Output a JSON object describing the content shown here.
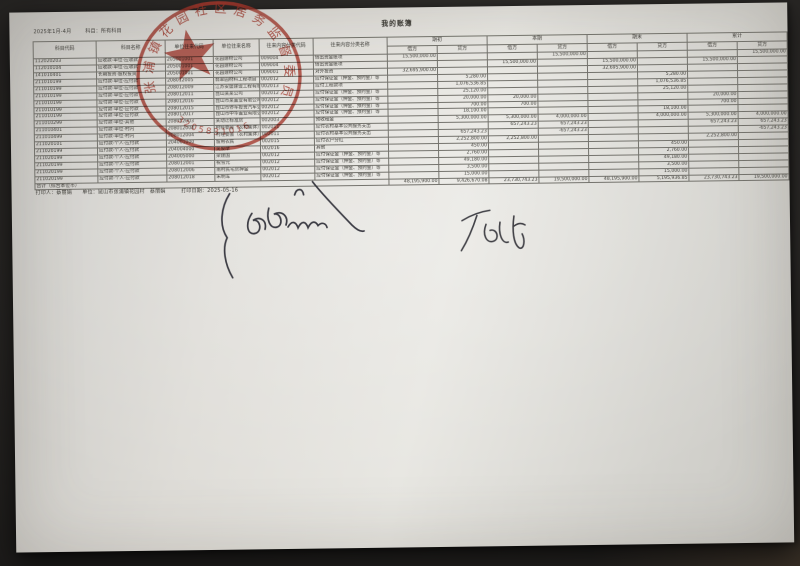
{
  "meta": {
    "period": "2025年1月-4月",
    "subject_filter": "科目：所有科目",
    "title": "我的账簿"
  },
  "table": {
    "headers": {
      "cols": [
        "科目代码",
        "科目名称",
        "单位往来代码",
        "单位往来名称",
        "往来内容分类代码",
        "往来内容分类名称"
      ],
      "groups": [
        "期初",
        "本期",
        "期末",
        "累计"
      ],
      "sub": [
        "借方",
        "贷方"
      ]
    },
    "rows": [
      [
        "112020203",
        "应收款-单位-应收款",
        "205001001",
        "花园建材公司",
        "009004",
        "借出资金账项",
        "15,500,000.00",
        "",
        "",
        "15,500,000.00",
        "",
        "",
        "",
        "15,500,000.00"
      ],
      [
        "112010104",
        "应收款-单位-应收款",
        "205001001",
        "花园建材公司",
        "009004",
        "借出资金账项",
        "",
        "",
        "15,500,000.00",
        "",
        "15,500,000.00",
        "",
        "15,500,000.00",
        ""
      ],
      [
        "141010401",
        "长期投资-股权投资",
        "205001001",
        "花园建材公司",
        "009001",
        "对外投资",
        "32,695,900.00",
        "",
        "",
        "",
        "32,695,900.00",
        "",
        "",
        ""
      ],
      [
        "211010199",
        "应付款-单位-应付款",
        "208012005",
        "翡翠园材料工程项目",
        "002012",
        "应付保证金（押金、预约金）等",
        "",
        "5,280.00",
        "",
        "",
        "",
        "5,280.00",
        "",
        ""
      ],
      [
        "211010199",
        "应付款-单位-应付款",
        "208012009",
        "江苏安盛建设工程有限公司",
        "002013",
        "应付工程款项",
        "",
        "1,076,536.85",
        "",
        "",
        "",
        "1,076,536.85",
        "",
        ""
      ],
      [
        "211010199",
        "应付款-单位-应付款",
        "208012011",
        "昆山某某公司",
        "002012",
        "应付保证金（押金、预约金）等",
        "",
        "25,120.00",
        "",
        "",
        "",
        "25,120.00",
        "",
        ""
      ],
      [
        "211010199",
        "应付款-单位-应付款",
        "208012016",
        "昆山市某置业有限公司",
        "002012",
        "应付保证金（押金、预约金）等",
        "",
        "20,000.00",
        "20,000.00",
        "",
        "",
        "",
        "20,000.00",
        ""
      ],
      [
        "211010199",
        "应付款-单位-应付款",
        "208012015",
        "昆山市停车投资汽车公司",
        "002012",
        "应付保证金（押金、预约金）等",
        "",
        "700.00",
        "700.00",
        "",
        "",
        "",
        "700.00",
        ""
      ],
      [
        "211010199",
        "应付款-单位-应付款",
        "208012017",
        "昆山市中华置业有限公司",
        "002012",
        "应付保证金（押金、预约金）等",
        "",
        "18,100.00",
        "",
        "",
        "",
        "18,100.00",
        "",
        ""
      ],
      [
        "211010299",
        "应付款-单位-其他",
        "208012003",
        "某动迁标准房",
        "002003",
        "预收租金",
        "",
        "5,300,000.00",
        "5,300,000.00",
        "4,000,000.00",
        "",
        "4,000,000.00",
        "5,300,000.00",
        "4,000,000.00"
      ],
      [
        "211010401",
        "应付款-单位-村内",
        "208012004",
        "村经委会（农村集体）",
        "002011",
        "应付农村基本公共服务支出",
        "",
        "",
        "657,243.23",
        "657,243.23",
        "",
        "",
        "657,243.23",
        "657,243.23"
      ],
      [
        "211010499",
        "应付款-单位-村内",
        "208012004",
        "村经委会（农村集体）",
        "002011",
        "应付农村基本公共服务支出",
        "",
        "657,243.23",
        "",
        "-657,243.23",
        "",
        "",
        "",
        "-657,243.23"
      ],
      [
        "211020101",
        "应付款-个人-应付款",
        "204001000",
        "留用农民",
        "002015",
        "应付农户分红",
        "",
        "2,252,800.00",
        "2,252,800.00",
        "",
        "",
        "",
        "2,252,800.00",
        ""
      ],
      [
        "211020199",
        "应付款-个人-应付款",
        "204004000",
        "吴俊摩",
        "002016",
        "其他",
        "",
        "450.00",
        "",
        "",
        "",
        "450.00",
        "",
        ""
      ],
      [
        "211020199",
        "应付款-个人-应付款",
        "204005000",
        "梁建国",
        "002012",
        "应付保证金（押金、预约金）等",
        "",
        "2,760.00",
        "",
        "",
        "",
        "2,760.00",
        "",
        ""
      ],
      [
        "211020199",
        "应付款-个人-应付款",
        "208012001",
        "祝雪元",
        "002012",
        "应付保证金（押金、预约金）等",
        "",
        "49,180.00",
        "",
        "",
        "",
        "49,180.00",
        "",
        ""
      ],
      [
        "211020199",
        "应付款-个人-应付款",
        "208012006",
        "南村民宅房押金",
        "002012",
        "应付保证金（押金、预约金）等",
        "",
        "3,500.00",
        "",
        "",
        "",
        "3,500.00",
        "",
        ""
      ],
      [
        "211020199",
        "应付款-个人-应付款",
        "208012018",
        "朱明军",
        "002012",
        "应付保证金（押金、预约金）等",
        "",
        "15,000.00",
        "",
        "",
        "",
        "15,000.00",
        "",
        ""
      ]
    ],
    "total": {
      "label": "合计（综合本位币）",
      "values": [
        "48,195,900.00",
        "9,426,670.08",
        "23,730,743.23",
        "19,500,000.00",
        "48,195,900.00",
        "5,195,936.85",
        "23,730,743.23",
        "19,500,000.00"
      ]
    }
  },
  "footer": {
    "line": "打印人：蔡丽娟　　单位：昆山市张浦镇花园村　蔡丽娟　　　打印日期：2025-05-16"
  },
  "stamp": {
    "arc_text": "张浦镇花园社区居务监督委员会",
    "serial": "3205831016",
    "color": "#b5392c"
  }
}
